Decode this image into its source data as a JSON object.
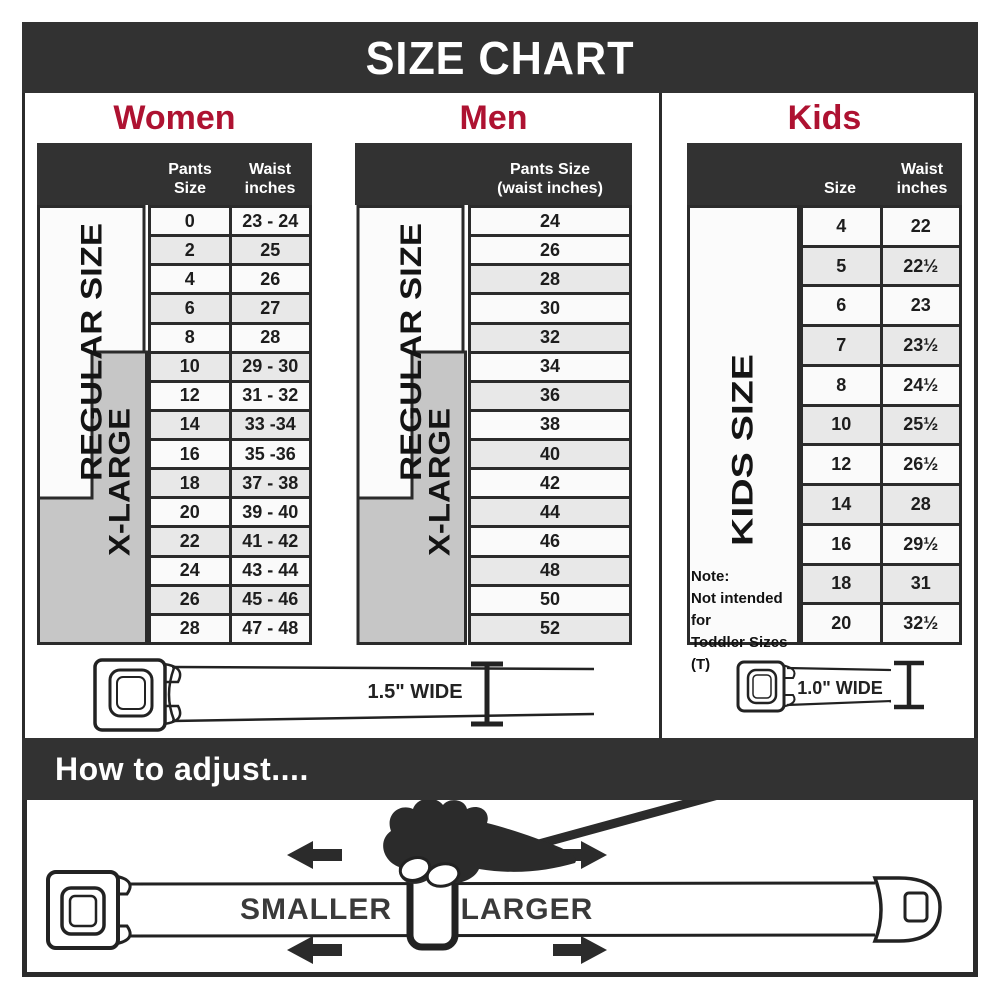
{
  "title": "SIZE CHART",
  "colors": {
    "dark": "#323232",
    "border": "#2b2b2b",
    "red": "#ae1231",
    "row_light": "#fafafa",
    "row_shade": "#e8e8e8",
    "xl_gray": "#c6c6c6",
    "ink": "#1d1d1d"
  },
  "women": {
    "heading": "Women",
    "col1_header": "Pants Size",
    "col2_header_line1": "Waist",
    "col2_header_line2": "inches",
    "regular_label": "REGULAR SIZE",
    "xlarge_label": "X-LARGE",
    "rows": [
      {
        "pants": "0",
        "waist": "23 - 24"
      },
      {
        "pants": "2",
        "waist": "25"
      },
      {
        "pants": "4",
        "waist": "26"
      },
      {
        "pants": "6",
        "waist": "27"
      },
      {
        "pants": "8",
        "waist": "28"
      },
      {
        "pants": "10",
        "waist": "29 - 30"
      },
      {
        "pants": "12",
        "waist": "31 - 32"
      },
      {
        "pants": "14",
        "waist": "33 -34"
      },
      {
        "pants": "16",
        "waist": "35 -36"
      },
      {
        "pants": "18",
        "waist": "37 - 38"
      },
      {
        "pants": "20",
        "waist": "39 - 40"
      },
      {
        "pants": "22",
        "waist": "41 - 42"
      },
      {
        "pants": "24",
        "waist": "43 - 44"
      },
      {
        "pants": "26",
        "waist": "45 - 46"
      },
      {
        "pants": "28",
        "waist": "47 - 48"
      }
    ]
  },
  "men": {
    "heading": "Men",
    "col_header_line1": "Pants Size",
    "col_header_line2": "(waist inches)",
    "regular_label": "REGULAR SIZE",
    "xlarge_label": "X-LARGE",
    "rows": [
      "24",
      "26",
      "28",
      "30",
      "32",
      "34",
      "36",
      "38",
      "40",
      "42",
      "44",
      "46",
      "48",
      "50",
      "52"
    ]
  },
  "kids": {
    "heading": "Kids",
    "col1_header": "Size",
    "col2_header_line1": "Waist",
    "col2_header_line2": "inches",
    "label": "KIDS SIZE",
    "note_line1": "Note:",
    "note_line2": "Not intended for",
    "note_line3": "Toddler Sizes (T)",
    "rows": [
      {
        "size": "4",
        "waist": "22"
      },
      {
        "size": "5",
        "waist": "22½"
      },
      {
        "size": "6",
        "waist": "23"
      },
      {
        "size": "7",
        "waist": "23½"
      },
      {
        "size": "8",
        "waist": "24½"
      },
      {
        "size": "10",
        "waist": "25½"
      },
      {
        "size": "12",
        "waist": "26½"
      },
      {
        "size": "14",
        "waist": "28"
      },
      {
        "size": "16",
        "waist": "29½"
      },
      {
        "size": "18",
        "waist": "31"
      },
      {
        "size": "20",
        "waist": "32½"
      }
    ]
  },
  "belts": {
    "adult_width_label": "1.5\" WIDE",
    "kids_width_label": "1.0\" WIDE"
  },
  "how_to": {
    "heading": "How to adjust....",
    "smaller": "SMALLER",
    "larger": "LARGER"
  }
}
